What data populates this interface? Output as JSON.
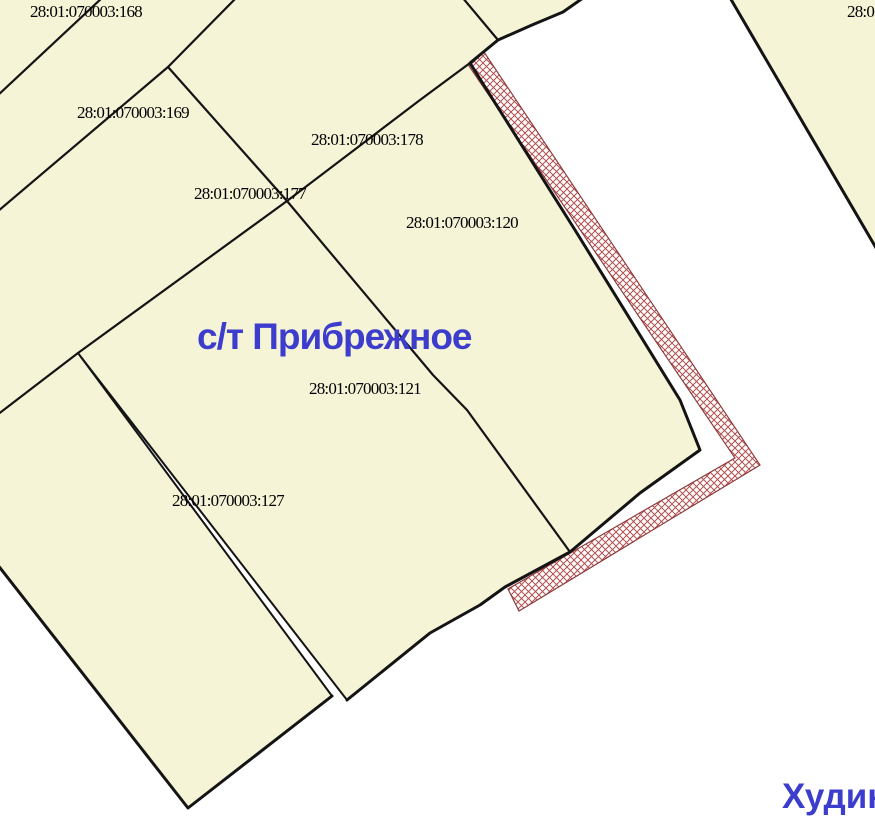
{
  "map": {
    "settlement_label": "с/т Прибрежное",
    "place_label": "Худин",
    "corner_parcel_label": "28:0",
    "parcels": [
      {
        "cadastral_number": "28:01:070003:168"
      },
      {
        "cadastral_number": "28:01:070003:169"
      },
      {
        "cadastral_number": "28:01:070003:178"
      },
      {
        "cadastral_number": "28:01:070003:177"
      },
      {
        "cadastral_number": "28:01:070003:120"
      },
      {
        "cadastral_number": "28:01:070003:121"
      },
      {
        "cadastral_number": "28:01:070003:127"
      }
    ],
    "colors": {
      "parcel_fill": "#f6f4d7",
      "boundary": "#141414",
      "hatch_outline": "#8f3d3d",
      "hatch_line": "#b25050",
      "toponym_blue": "#3c3ccd",
      "background": "#ffffff"
    }
  }
}
